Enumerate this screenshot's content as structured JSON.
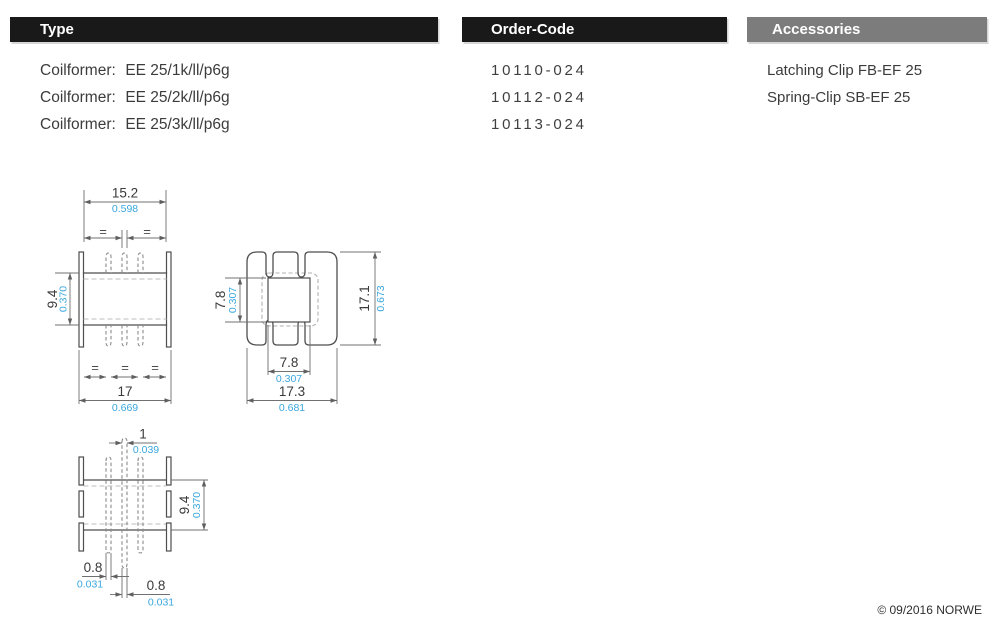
{
  "columns": {
    "type": {
      "header": "Type",
      "rows": [
        {
          "prefix": "Coilformer:",
          "name": "EE 25/1k/ll/p6g"
        },
        {
          "prefix": "Coilformer:",
          "name": "EE 25/2k/ll/p6g"
        },
        {
          "prefix": "Coilformer:",
          "name": "EE 25/3k/ll/p6g"
        }
      ]
    },
    "order_code": {
      "header": "Order-Code",
      "rows": [
        "10110-024",
        "10112-024",
        "10113-024"
      ]
    },
    "accessories": {
      "header": "Accessories",
      "rows": [
        "Latching Clip FB-EF 25",
        "Spring-Clip SB-EF 25"
      ]
    }
  },
  "drawings": {
    "equal_symbol": "=",
    "front_view": {
      "width_top": {
        "mm": "15.2",
        "inch": "0.598"
      },
      "height_left": {
        "mm": "9.4",
        "inch": "0.370"
      },
      "width_bottom": {
        "mm": "17",
        "inch": "0.669"
      }
    },
    "side_view": {
      "window_height": {
        "mm": "7.8",
        "inch": "0.307"
      },
      "overall_height": {
        "mm": "17.1",
        "inch": "0.673"
      },
      "window_width": {
        "mm": "7.8",
        "inch": "0.307"
      },
      "overall_width": {
        "mm": "17.3",
        "inch": "0.681"
      }
    },
    "pin_view": {
      "pin_width_top": {
        "mm": "1",
        "inch": "0.039"
      },
      "body_height": {
        "mm": "9.4",
        "inch": "0.370"
      },
      "pin_width_left": {
        "mm": "0.8",
        "inch": "0.031"
      },
      "pin_width_right": {
        "mm": "0.8",
        "inch": "0.031"
      }
    }
  },
  "footer": {
    "copyright": "© 09/2016 NORWE"
  },
  "colors": {
    "header_dark": "#191919",
    "header_gray": "#7c7c7c",
    "inch_blue": "#3aa7dd"
  }
}
